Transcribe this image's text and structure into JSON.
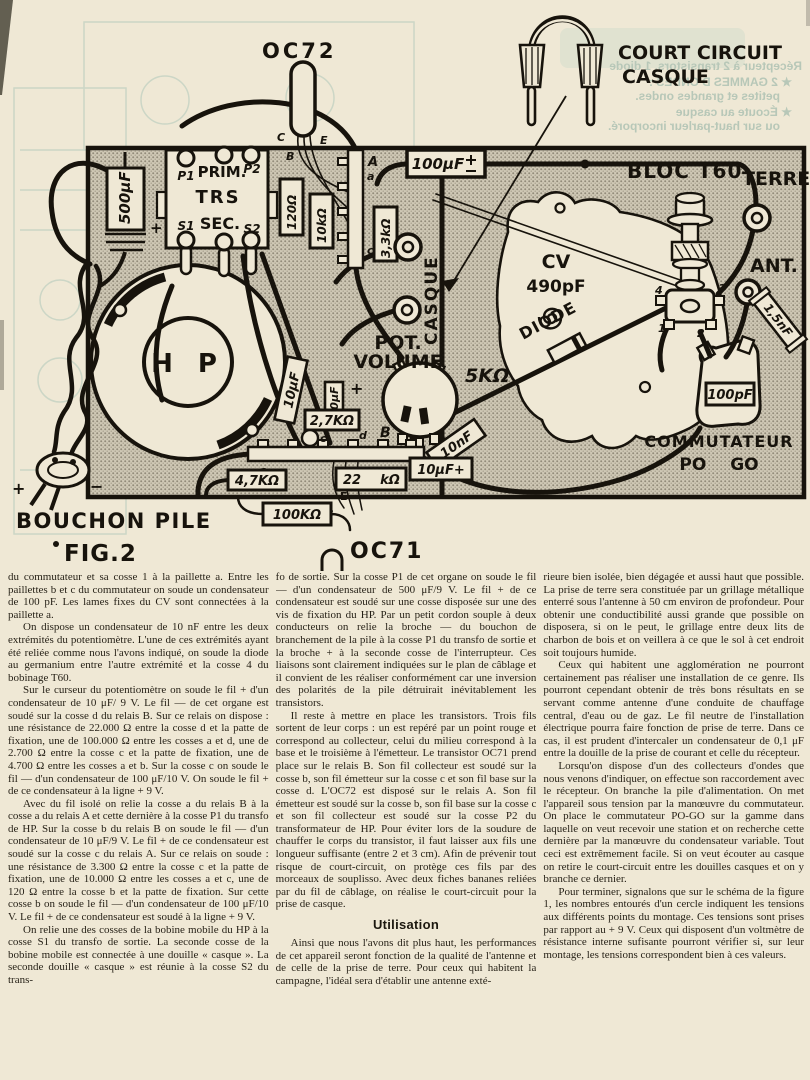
{
  "fig": {
    "oc72": "OC72",
    "court1": "COURT CIRCUIT",
    "court2": "CASQUE",
    "bloc_t60": "BLOC T60",
    "terre": "TERRE",
    "ant": "ANT.",
    "cv": "CV",
    "cv_value": "490pF",
    "diode": "DIODE",
    "casque_vert": "CASQUE",
    "pot1": "POT.",
    "pot2": "VOLUME",
    "pot_value": "5KΩ",
    "hp": "H P",
    "p1": "P1",
    "prim": "PRIM.",
    "p2": "P2",
    "trs": "TRS",
    "sec": "SEC.",
    "s1": "S1",
    "s2": "S2",
    "c500": "500μF",
    "c100top": "100μF",
    "r120": "120Ω",
    "r10k": "10kΩ",
    "r3k3": "3,3kΩ",
    "relais_a": "A",
    "relais_b": "B",
    "cosse_a": "a",
    "cosse_c": "c",
    "cosse_d": "d",
    "t_c": "C",
    "t_e": "E",
    "t_b": "B",
    "e_small": "E",
    "b_small": "B",
    "c10left": "10μF",
    "c100mid": "100μF",
    "r2k7": "2,7KΩ",
    "c10nf": "10nF",
    "c10bot": "10μF+",
    "r4k7": "4,7KΩ",
    "r22": "22",
    "r22u": "kΩ",
    "r100k": "100KΩ",
    "oc71": "OC71",
    "c100pf": "100pF",
    "commutateur": "COMMUTATEUR",
    "po_go": "PO GO",
    "c1n5": "1,5nF",
    "bouchon": "BOUCHON PILE",
    "fig2": "FIG.2",
    "plus": "+",
    "minus": "−",
    "n1": "1",
    "n2": "2",
    "n3": "3",
    "n4": "4"
  },
  "ghost": {
    "lines": [
      "Récepteur à 2 transistors, 1 diode",
      "★ 2 GAMMES D'ONDES :",
      "petites et grandes ondes.",
      "★ Écoute au casque",
      "ou sur haut-parleur incorporé."
    ]
  },
  "article": {
    "col1": [
      "du commutateur et sa cosse 1 à la paillette a. Entre les paillettes b et c du commutateur on soude un condensateur de 100 pF. Les lames fixes du CV sont connectées à la paillette a.",
      "On dispose un condensateur de 10 nF entre les deux extrémités du potentiomètre. L'une de ces extrémités ayant été reliée comme nous l'avons indiqué, on soude la diode au germanium entre l'autre extrémité et la cosse 4 du bobinage T60.",
      "Sur le curseur du potentiomètre on soude le fil + d'un condensateur de 10 μF/ 9 V. Le fil — de cet organe est soudé sur la cosse d du relais B. Sur ce relais on dispose : une résistance de 22.000 Ω entre la cosse d et la patte de fixation, une de 100.000 Ω entre les cosses a et d, une de 2.700 Ω entre la cosse c et la patte de fixation, une de 4.700 Ω entre les cosses a et b. Sur la cosse c on soude le fil — d'un condensateur de 100 μF/10 V. On soude le fil + de ce condensateur à la ligne + 9 V.",
      "Avec du fil isolé on relie la cosse a du relais B à la cosse a du relais A et cette dernière à la cosse P1 du transfo de HP. Sur la cosse b du relais B on soude le fil — d'un condensateur de 10 μF/9 V. Le fil + de ce condensateur est soudé sur la cosse c du relais A. Sur ce relais on soude : une résistance de 3.300 Ω entre la cosse c et la patte de fixation, une de 10.000 Ω entre les cosses a et c, une de 120 Ω entre la cosse b et la patte de fixation. Sur cette cosse b on soude le fil — d'un condensateur de 100 μF/10 V. Le fil + de ce condensateur est soudé à la ligne + 9 V.",
      "On relie une des cosses de la bobine mobile du HP à la cosse S1 du transfo de sortie. La seconde cosse de la bobine mobile est connectée à une douille « casque ». La seconde douille « casque » est réunie à la cosse S2 du trans-"
    ],
    "col2a": [
      "fo de sortie. Sur la cosse P1 de cet organe on soude le fil — d'un condensateur de 500 μF/9 V. Le fil + de ce condensateur est soudé sur une cosse disposée sur une des vis de fixation du HP. Par un petit cordon souple à deux conducteurs on relie la broche — du bouchon de branchement de la pile à la cosse P1 du transfo de sortie et la broche + à la seconde cosse de l'interrupteur. Ces liaisons sont clairement indiquées sur le plan de câblage et il convient de les réaliser conformément car une inversion des polarités de la pile détruirait inévitablement les transistors.",
      "Il reste à mettre en place les transistors. Trois fils sortent de leur corps : un est repéré par un point rouge et correspond au collecteur, celui du milieu correspond à la base et le troisième à l'émetteur. Le transistor OC71 prend place sur le relais B. Son fil collecteur est soudé sur la cosse b, son fil émetteur sur la cosse c et son fil base sur la cosse d. L'OC72 est disposé sur le relais A. Son fil émetteur est soudé sur la cosse b, son fil base sur la cosse c et son fil collecteur est soudé sur la cosse P2 du transformateur de HP. Pour éviter lors de la soudure de chauffer le corps du transistor, il faut laisser aux fils une longueur suffisante (entre 2 et 3 cm). Afin de prévenir tout risque de court-circuit, on protège ces fils par des morceaux de souplisso. Avec deux fiches bananes reliées par du fil de câblage, on réalise le court-circuit pour la prise de casque."
    ],
    "heading": "Utilisation",
    "col2b": [
      "Ainsi que nous l'avons dit plus haut, les performances de cet appareil seront fonction de la qualité de l'antenne et de celle de la prise de terre. Pour ceux qui habitent la campagne, l'idéal sera d'établir une antenne exté-"
    ],
    "col3": [
      "rieure bien isolée, bien dégagée et aussi haut que possible. La prise de terre sera constituée par un grillage métallique enterré sous l'antenne à 50 cm environ de profondeur. Pour obtenir une conductibilité aussi grande que possible on disposera, si on le peut, le grillage entre deux lits de charbon de bois et on veillera à ce que le sol à cet endroit soit toujours humide.",
      "Ceux qui habitent une agglomération ne pourront certainement pas réaliser une installation de ce genre. Ils pourront cependant obtenir de très bons résultats en se servant comme antenne d'une conduite de chauffage central, d'eau ou de gaz. Le fil neutre de l'installation électrique pourra faire fonction de prise de terre. Dans ce cas, il est prudent d'intercaler un condensateur de 0,1 μF entre la douille de la prise de courant et celle du récepteur.",
      "Lorsqu'on dispose d'un des collecteurs d'ondes que nous venons d'indiquer, on effectue son raccordement avec le récepteur. On branche la pile d'alimentation. On met l'appareil sous tension par la manœuvre du commutateur. On place le commutateur PO-GO sur la gamme dans laquelle on veut recevoir une station et on recherche cette dernière par la manœuvre du condensateur variable. Tout ceci est extrêmement facile. Si on veut écouter au casque on retire le court-circuit entre les douilles casques et on y branche ce dernier.",
      "Pour terminer, signalons que sur le schéma de la figure 1, les nombres entourés d'un cercle indiquent les tensions aux différents points du montage. Ces tensions sont prises par rapport au + 9 V. Ceux qui disposent d'un voltmètre de résistance interne sufisante pourront vérifier si, sur leur montage, les tensions correspondent bien à ces valeurs."
    ]
  }
}
